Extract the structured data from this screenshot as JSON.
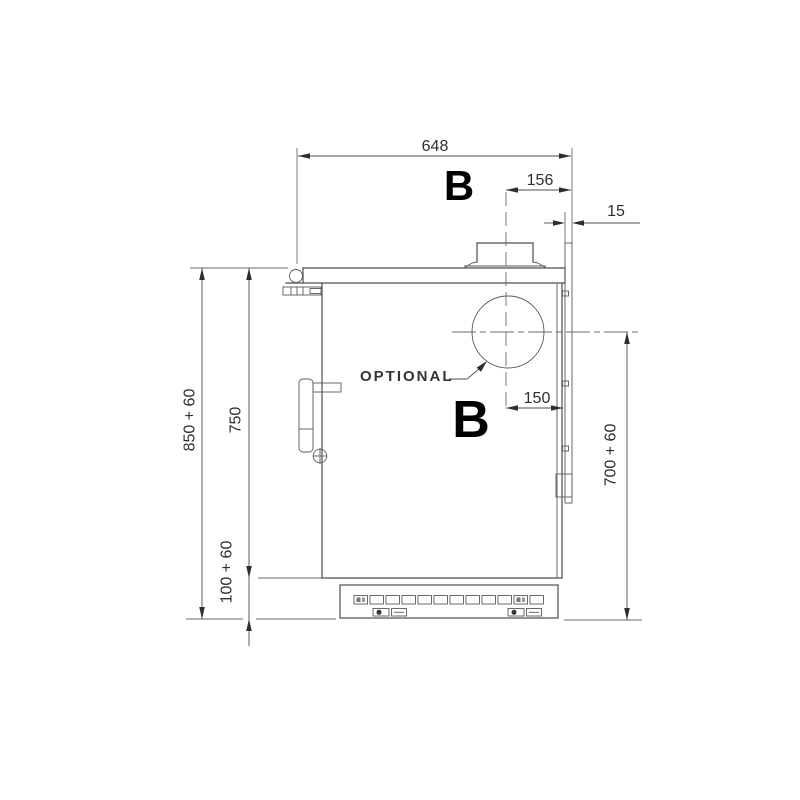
{
  "diagram": {
    "dimensions": {
      "top_width": "648",
      "flue_offset_from_rear": "156",
      "rear_gap": "15",
      "rear_outlet_offset": "150",
      "overall_height": "850 + 60",
      "front_height": "750",
      "base_height": "100 + 60",
      "rear_outlet_height": "700 + 60"
    },
    "labels": {
      "optional": "OPTIONAL",
      "marker_top": "B",
      "marker_front": "B"
    },
    "colors": {
      "line": "#4d4d4d",
      "dimension_text": "#2e2e2e",
      "marker_text": "#000000",
      "background": "#ffffff"
    }
  }
}
